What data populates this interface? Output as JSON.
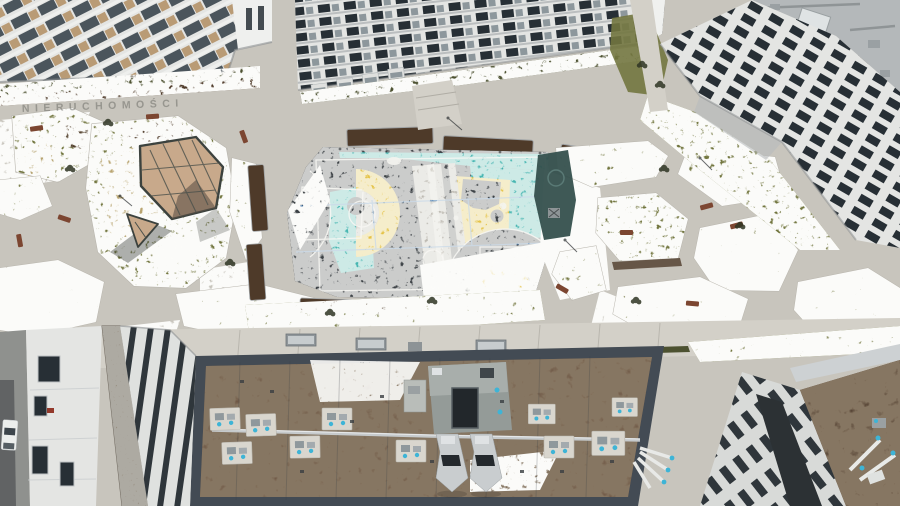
{
  "scene": {
    "type": "aerial-drone-photo",
    "description": "Top-down drone view of a modern apartment complex courtyard in winter: multicolor basketball court, landscaped plaza with glass pergola, snow-dusted lawns, and a large flat green roof with HVAC equipment.",
    "watermark": "NIERUCHOMOŚCI"
  },
  "palette": {
    "concrete": "#c8c5bd",
    "concrete_light": "#d3d0c8",
    "grass": "#72763f",
    "grass_dark": "#4c5130",
    "snow": "#f4f4f0",
    "mulch": "#4e3a29",
    "dry_grass": "#c4ad79",
    "court_dark": "#3c4145",
    "court_teal": "#46b6b1",
    "court_yellow": "#e4c244",
    "court_gray": "#bdbab2",
    "line_white": "#eceae4",
    "line_blue": "#3d7ab8",
    "facade_white": "#e4e5e3",
    "window_dark": "#272f35",
    "balcony_glass": "#8d979c",
    "balcony_wood": "#b08a5c",
    "roof_brown": "#6b5341",
    "roof_parapet": "#434b54",
    "pad_white": "#d9d6ce",
    "hvac_gray": "#8f989c",
    "vent_cyan": "#3eb4d6",
    "canopy_tan": "#c8a98b",
    "bench_brown": "#7c4631",
    "roof_gray": "#b4b8ba",
    "hedge_green": "#4c5130",
    "stone": "#968e80",
    "street": "#8f918e",
    "playground_dark": "#35504d"
  }
}
